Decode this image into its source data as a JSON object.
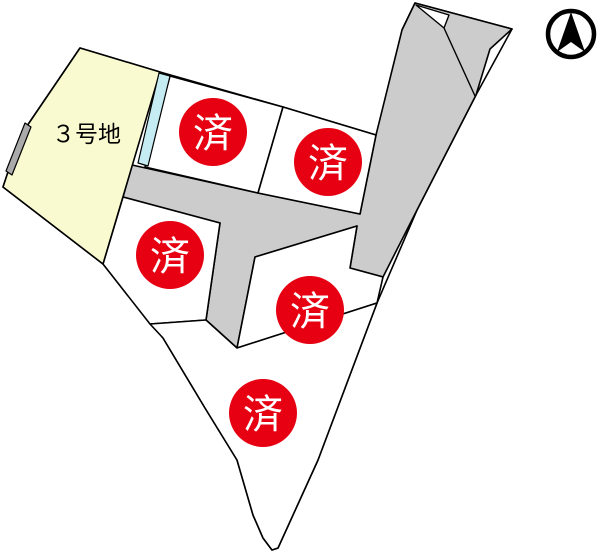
{
  "diagram": {
    "type": "land-lot-sales-map",
    "available_lot": {
      "label": "３号地",
      "status": "available"
    },
    "sold_lots": [
      {
        "id": "lot-top-left",
        "marker": "済"
      },
      {
        "id": "lot-top-right",
        "marker": "済"
      },
      {
        "id": "lot-middle-left",
        "marker": "済"
      },
      {
        "id": "lot-middle-right",
        "marker": "済"
      },
      {
        "id": "lot-bottom",
        "marker": "済"
      }
    ],
    "north_arrow": {
      "icon": "north-arrow-icon"
    },
    "colors": {
      "background": "#ffffff",
      "outline": "#000000",
      "available_lot_fill": "#FAFAD0",
      "lot_fill": "#ffffff",
      "road_fill": "#CCCCCC",
      "waterway_fill": "#C4ECF2",
      "wall_fill": "#AAAAAA",
      "sold_marker_fill": "#E60012",
      "sold_marker_text": "#FFFFFF"
    }
  }
}
